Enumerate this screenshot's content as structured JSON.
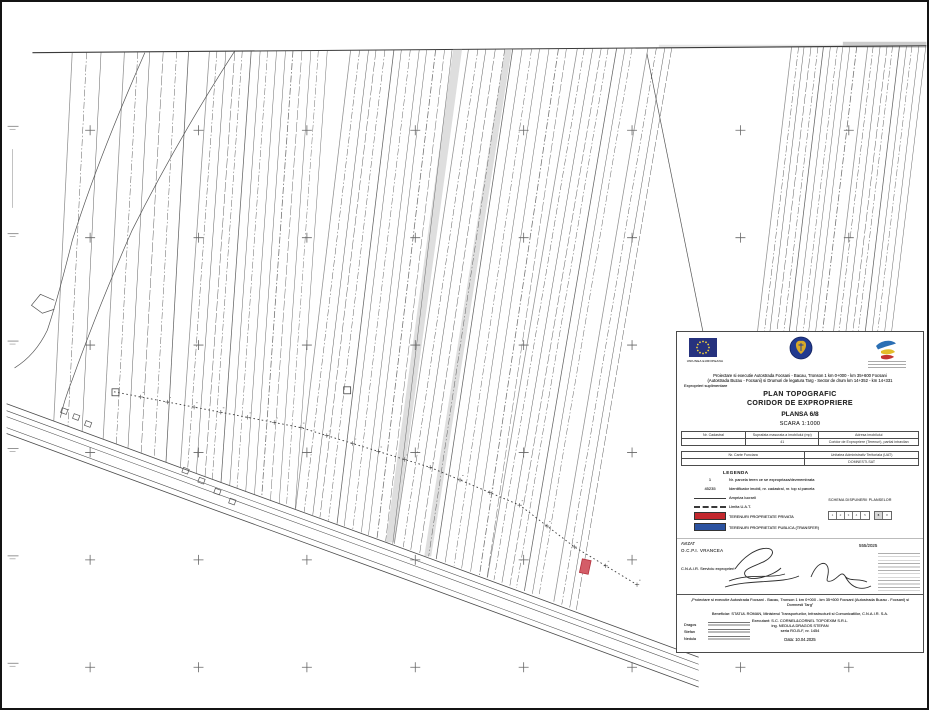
{
  "document": {
    "type_label": "PLAN TOPOGRAFIC",
    "subtitle": "CORIDOR DE EXPROPRIERE",
    "sheet": "PLANSA 6/8",
    "scale": "SCARA 1:1000",
    "project_line1": "Proiectare si executie Autostrada Focsani - Bacau, Tronson 1 km 0+000 - km 35+600 Focsani",
    "project_line2": "(Autostrada Buzau - Focsani) si Drumuri de legatura Targ - Sector de drum km 14+352 - km 14+331",
    "project_line3": "Exproprieri suplimentare",
    "eu_caption": "UNIUNEA EUROPEANA"
  },
  "table1": {
    "headers": [
      "Nr. Cadastral",
      "Suprafata masurata a imobilului (mp)",
      "Adresa imobilului"
    ],
    "row": [
      "",
      "41",
      "Coridor de Expropriere (Terenuri), partial intravilan"
    ]
  },
  "table2": {
    "headers": [
      "Nr. Carte Funciara",
      "Unitatea Administrativ Teritoriala (UAT)"
    ],
    "row": [
      "",
      "DOMNESTI-SAT"
    ]
  },
  "legend": {
    "title": "LEGENDA",
    "items": [
      {
        "symbol": "1",
        "label": "Nr. parcela teren ce se expropriaza/dezmembrata"
      },
      {
        "symbol": "45235",
        "label": "Identificator imobil, nr. cadastral, nr. top si parcela"
      },
      {
        "symbol": "",
        "label": "Ampriza lucrarii"
      },
      {
        "symbol": "",
        "label": "Limita U.A.T."
      },
      {
        "symbol": "",
        "label": "TERENURI PROPRIETATE PRIVATA"
      },
      {
        "symbol": "",
        "label": "TERENURI PROPRIETATE PUBLICA (TRANSFER)"
      }
    ]
  },
  "schema": {
    "title": "SCHEMA DISPUNERII PLANSELOR",
    "cells": [
      "1",
      "2",
      "3",
      "4",
      "5"
    ],
    "cells2": [
      "6",
      "8"
    ],
    "highlight": "6"
  },
  "approval": {
    "avizat": "AVIZAT",
    "ocpi": "O.C.P.I. VRANCEA",
    "cnair": "C.N.A.I.R. Serviciu exproprieri",
    "aviz_number": "555/2025"
  },
  "footer": {
    "project_quote1": "„Proiectare si executie Autostrada Focsani - Bacau, Tronson 1 km 0+000 - km 35+600 Focsani (Autostrada Buzau - Focsani) si",
    "project_quote2": "Domnesti Targ”",
    "beneficiary": "Beneficiar: STATUL ROMAN, Ministerul Transporturilor, Infrastructurii si Comunicatiilor, C.N.A.I.R. S.A.",
    "executant": "Executant: S.C. CORNEL&CORNEL TOPOEXIM S.R.L.",
    "engineer": "ing. NEDULA DRAGOS STEFAN",
    "series": "seria RO-B-F, nr. 1454",
    "date": "Data: 10.04.2025",
    "names": [
      "Dragos",
      "Stefan",
      "Nedula"
    ]
  },
  "colors": {
    "private_red": "#c3282e",
    "public_blue": "#2b52a0",
    "eu_blue": "#26327e",
    "emblem_blue": "#223a8f",
    "map_ink": "#4c4c4c"
  },
  "map": {
    "ink": "#4c4c4c",
    "frame_top": [
      [
        30,
        51
      ],
      [
        929,
        44
      ]
    ],
    "grid": {
      "cols": [
        88,
        197,
        306,
        415,
        524,
        633,
        742,
        851
      ],
      "rows": [
        129,
        237,
        345,
        453,
        561,
        669
      ],
      "arm": 5
    },
    "clusters": [
      {
        "x0": 70,
        "n": 3,
        "gap": 14,
        "lean": -0.05
      },
      {
        "x0": 122,
        "n": 6,
        "gap": 13,
        "lean": -0.055
      },
      {
        "x0": 207,
        "n": 15,
        "gap": 8.5,
        "lean": -0.07
      },
      {
        "x0": 350,
        "n": 13,
        "gap": 8.5,
        "lean": -0.12
      },
      {
        "x0": 468,
        "n": 12,
        "gap": 9,
        "lean": -0.15
      },
      {
        "x0": 577,
        "n": 8,
        "gap": 8,
        "lean": -0.17
      },
      {
        "x0": 649,
        "n": 4,
        "gap": 8,
        "lean": -0.17
      },
      {
        "x0": 793,
        "n": 11,
        "gap": 6.5,
        "lean": -0.12,
        "yMax": 650
      },
      {
        "x0": 869,
        "n": 10,
        "gap": 6.5,
        "lean": -0.12,
        "yMax": 650
      }
    ],
    "road": {
      "pts": [
        [
          4,
          404
        ],
        [
          200,
          476
        ],
        [
          420,
          556
        ],
        [
          700,
          659
        ]
      ],
      "offsets": [
        0,
        7,
        13,
        24,
        30
      ]
    },
    "arcs": [
      "M143,51 Q95,160 70,240 Q55,300 45,330 Q33,355 12,368",
      "M233,50 Q175,140 130,230 Q95,310 70,380 Q62,400 58,418",
      "M648,52 L706,340"
    ],
    "notch": [
      [
        52,
        300
      ],
      [
        38,
        294
      ],
      [
        29,
        305
      ],
      [
        40,
        313
      ],
      [
        52,
        309
      ]
    ],
    "corridor": [
      [
        112,
        392
      ],
      [
        300,
        428
      ],
      [
        430,
        468
      ],
      [
        520,
        506
      ],
      [
        575,
        548
      ],
      [
        638,
        586
      ]
    ],
    "red_parcel": {
      "x": 583,
      "y": 560,
      "w": 9,
      "h": 14
    },
    "gray_strips": [
      {
        "x": 453,
        "w": 9,
        "lean": -0.13
      },
      {
        "x": 505,
        "w": 7,
        "lean": -0.15
      }
    ],
    "squares": [
      [
        110,
        389
      ],
      [
        343,
        387
      ]
    ],
    "buildings": [
      [
        182,
        468
      ],
      [
        198,
        478
      ],
      [
        214,
        489
      ],
      [
        229,
        499
      ],
      [
        60,
        408
      ],
      [
        72,
        414
      ],
      [
        84,
        421
      ]
    ],
    "left_segs": [
      [
        10,
        148,
        10,
        207
      ]
    ],
    "smudges": [
      {
        "x": 845,
        "y": 40,
        "w": 84,
        "h": 6,
        "o": 0.5
      },
      {
        "x": 660,
        "y": 43,
        "w": 185,
        "h": 3,
        "o": 0.25
      }
    ]
  }
}
